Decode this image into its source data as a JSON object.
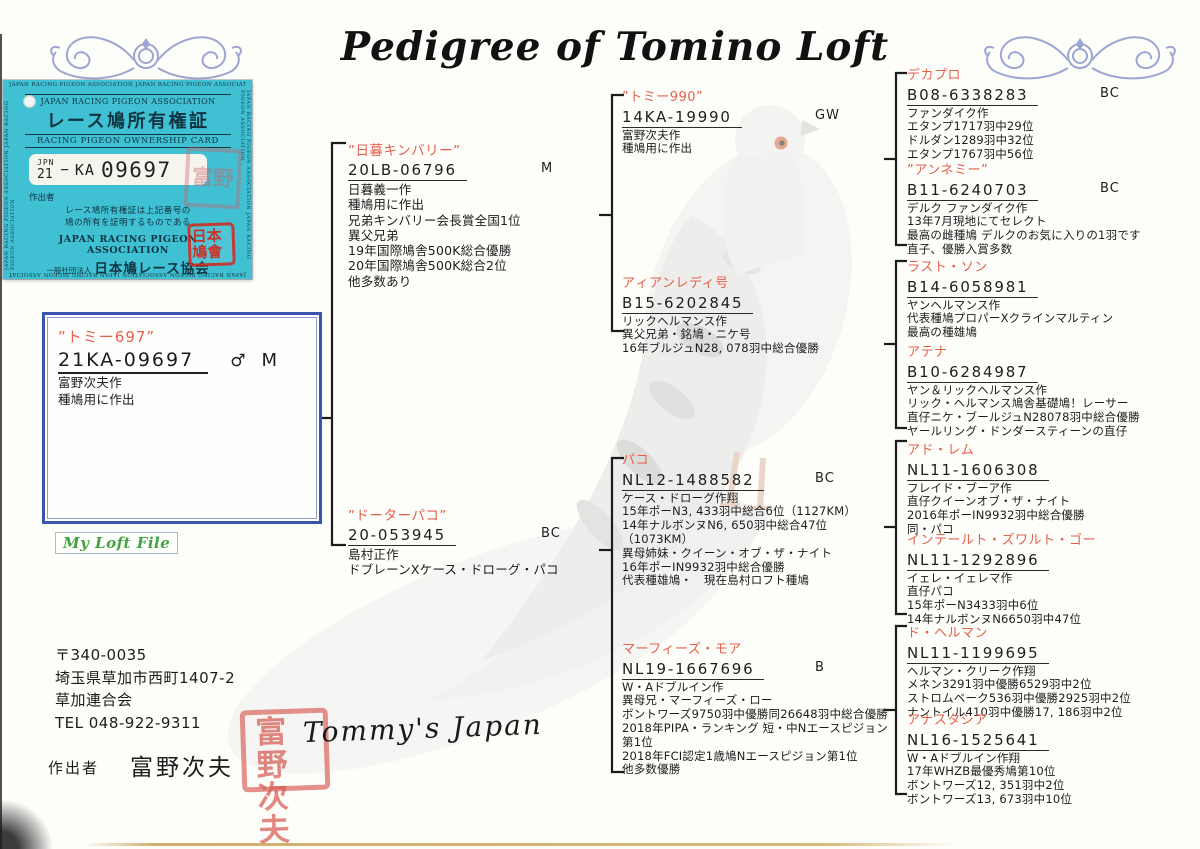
{
  "page": {
    "title": "Pedigree of Tomino Loft"
  },
  "card": {
    "edge_text": "JAPAN RACING PIGEON ASSOCIATION JAPAN RACING PIGEON ASSOCIATION",
    "org_en": "JAPAN RACING PIGEON ASSOCIATION",
    "title_jp": "レース鳩所有権証",
    "title_en": "RACING PIGEON OWNERSHIP CARD",
    "ring": {
      "country": "JPN",
      "year": "21",
      "dash": "−",
      "area": "KA",
      "number": "09697"
    },
    "breeder_label": "作出者",
    "statement_line1": "レース鳩所有権証は上記番号の",
    "statement_line2": "鳩の所有を証明するものである",
    "footer_en": "JAPAN RACING PIGEON ASSOCIATION",
    "footer_jp_prefix": "一般社団法人",
    "footer_jp": "日本鳩レース協会",
    "assoc_seal_text": "日本鳩會",
    "faint_seal_text": "富野"
  },
  "subject": {
    "name": "”トミー697”",
    "ring": "21KA-09697",
    "sex": "♂",
    "band": "M",
    "lines": [
      "富野次夫作",
      "種鳩用に作出"
    ]
  },
  "loft_file_label": "My Loft File",
  "footer": {
    "postal": "〒340-0035",
    "address": "埼玉県草加市西町1407-2",
    "club": "草加連合会",
    "tel": "TEL 048-922-9311",
    "breeder_label": "作出者",
    "breeder_name": "富野次夫",
    "signature": "Tommy's Japan",
    "seal_text": "富野次夫"
  },
  "pedigree": {
    "sire": {
      "name": "”日暮キンバリー”",
      "ring": "20LB-06796",
      "band": "M",
      "lines": [
        "日暮義一作",
        "種鳩用に作出",
        "兄弟キンバリー会長賞全国1位",
        "異父兄弟",
        "19年国際鳩舎500K総合優勝",
        "20年国際鳩舎500K総合2位",
        "他多数あり"
      ]
    },
    "dam": {
      "name": "”ドーターパコ”",
      "ring": "20-053945",
      "band": "BC",
      "lines": [
        "島村正作",
        "ドブレーンXケース・ドローグ・パコ"
      ]
    },
    "sire_sire": {
      "name": "”トミー990”",
      "ring": "14KA-19990",
      "band": "GW",
      "lines": [
        "富野次夫作",
        "種鳩用に作出"
      ]
    },
    "sire_dam": {
      "name": "アィアンレディ号",
      "ring": "B15-6202845",
      "band": "",
      "lines": [
        "リックヘルマンス作",
        "異父兄弟・銘鳩・ニケ号",
        "16年ブルジュN28, 078羽中総合優勝"
      ]
    },
    "dam_sire": {
      "name": "パコ",
      "ring": "NL12-1488582",
      "band": "BC",
      "lines": [
        "ケース・ドローグ作翔",
        "15年ポーN3, 433羽中総合6位（1127KM）",
        "14年ナルボンヌN6, 650羽中総合47位（1073KM）",
        "異母姉妹・クイーン・オブ・ザ・ナイト",
        "16年ポーIN9932羽中総合優勝",
        "代表種雄鳩・　現在島村ロフト種鳩"
      ]
    },
    "dam_dam": {
      "name": "マーフィーズ・モア",
      "ring": "NL19-1667696",
      "band": "B",
      "lines": [
        "W・Aドブルイン作",
        "異母兄・マーフィーズ・ロー",
        "ボントワーズ9750羽中優勝同26648羽中総合優勝",
        "2018年PIPA・ランキング 短・中Nエースピジョン第1位",
        "2018年FCI認定1歳鳩Nエースピジョン第1位",
        "他多数優勝"
      ]
    },
    "gg": [
      {
        "name": "デカプロ",
        "ring": "B08-6338283",
        "band": "BC",
        "lines": [
          "ファンダイク作",
          "エタンプ1717羽中29位",
          "ドルダン1289羽中32位",
          "エタンプ1767羽中56位"
        ]
      },
      {
        "name": "”アンネミー”",
        "ring": "B11-6240703",
        "band": "BC",
        "lines": [
          "デルク ファンダイク作",
          "13年7月現地にてセレクト",
          "最高の雌種鳩 デルクのお気に入りの1羽です",
          "直子、優勝入賞多数"
        ]
      },
      {
        "name": "ラスト・ソン",
        "ring": "B14-6058981",
        "band": "",
        "lines": [
          "ヤンヘルマンス作",
          "代表種鳩プロパーXクラインマルティン",
          "最高の種雄鳩"
        ]
      },
      {
        "name": "アテナ",
        "ring": "B10-6284987",
        "band": "",
        "lines": [
          "ヤン＆リックヘルマンス作",
          "リック・ヘルマンス鳩舎基礎鳩！レーサー",
          "直仔ニケ・ブールジュN28078羽中総合優勝",
          "ヤールリング・ドンダースティーンの直仔"
        ]
      },
      {
        "name": "アド・レム",
        "ring": "NL11-1606308",
        "band": "",
        "lines": [
          "フレイド・ブーア作",
          "直仔クイーンオブ・ザ・ナイト",
          "2016年ポーIN9932羽中総合優勝",
          "同・パコ"
        ]
      },
      {
        "name": "インテールト・ズワルト・ゴー",
        "ring": "NL11-1292896",
        "band": "",
        "lines": [
          "イェレ・イェレマ作",
          "直仔パコ",
          "15年ポーN3433羽中6位",
          "14年ナルボンヌN6650羽中47位"
        ]
      },
      {
        "name": "ド・ヘルマン",
        "ring": "NL11-1199695",
        "band": "",
        "lines": [
          "ヘルマン・クリーク作翔",
          "メネン3291羽中優勝6529羽中2位",
          "ストロムベーク536羽中優勝2925羽中2位",
          "ナントイル410羽中優勝17, 186羽中2位"
        ]
      },
      {
        "name": "アナスタシア",
        "ring": "NL16-1525641",
        "band": "",
        "lines": [
          "W・Aドブルイン作翔",
          "17年WHZB最優秀鳩第10位",
          "ボントワーズ12, 351羽中2位",
          "ボントワーズ13, 673羽中10位"
        ]
      }
    ]
  }
}
